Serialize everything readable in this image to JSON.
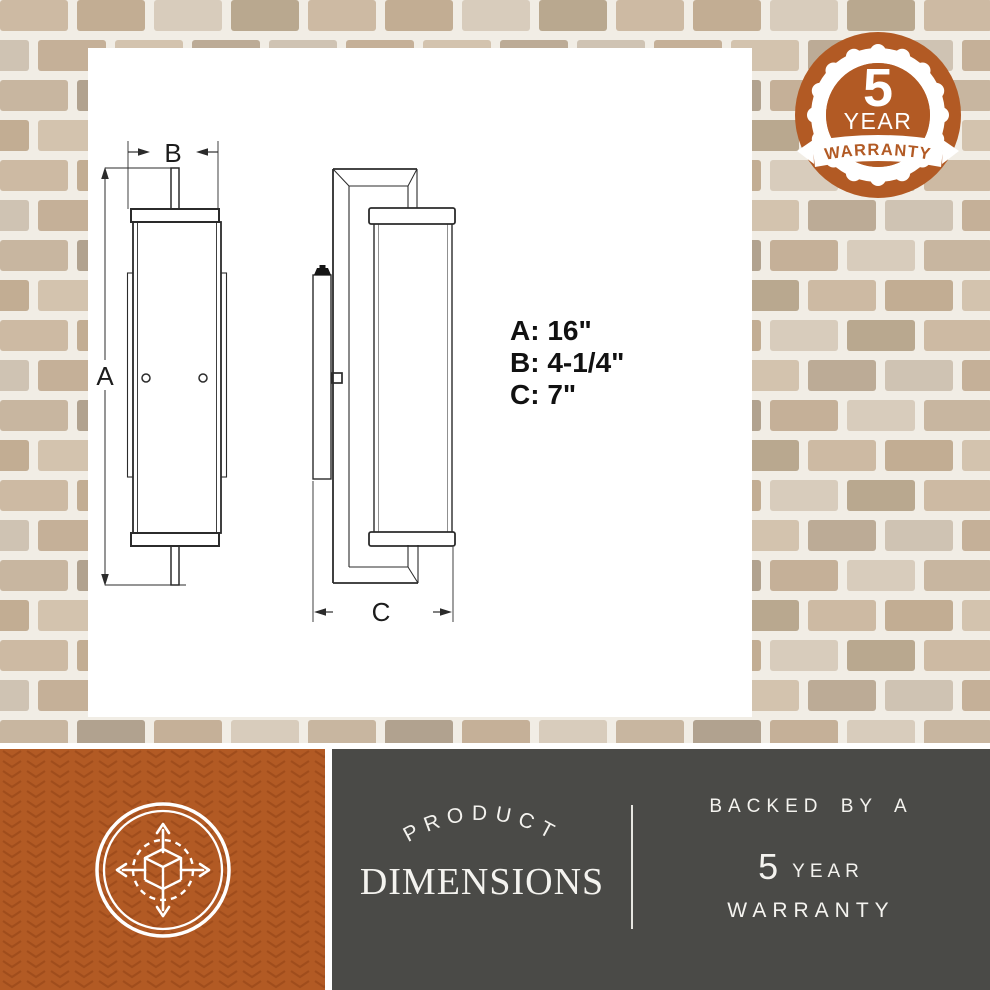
{
  "drawing": {
    "labels": {
      "a": "A",
      "b": "B",
      "c": "C"
    },
    "dims": {
      "a": "A: 16\"",
      "b": "B: 4-1/4\"",
      "c": "C: 7\""
    },
    "views": [
      "front-view-wall-sconce",
      "side-view-wall-sconce"
    ],
    "line_color": "#2b2b2b"
  },
  "warranty_badge": {
    "number": "5",
    "year_label": "YEAR",
    "warranty_label": "WARRANTY",
    "colors": {
      "orange": "#b25a24",
      "white": "#ffffff"
    }
  },
  "banner": {
    "product_label": "PRODUCT",
    "dimensions_label": "DIMENSIONS",
    "backed_by_label": "BACKED BY A",
    "five_label": "5",
    "year_label": "YEAR",
    "warranty_label": "WARRANTY",
    "colors": {
      "orange_bg": "#b25a24",
      "dark_bg": "#4a4a47",
      "pattern": "#8e3f13"
    }
  },
  "icons": {
    "dimensions_icon": "cube-expand-arrows-icon",
    "badge_icon": "5-year-warranty-seal"
  },
  "background": {
    "style": "tan-brick-wall",
    "mortar_color": "#f1ede5",
    "brick_colors": [
      "#cdbaa3",
      "#c2ad93",
      "#d8ccbc",
      "#b9a88f",
      "#cfc3b3",
      "#c5b098",
      "#d3c3ae",
      "#bcab96",
      "#c8b6a0",
      "#b1a28f"
    ]
  }
}
